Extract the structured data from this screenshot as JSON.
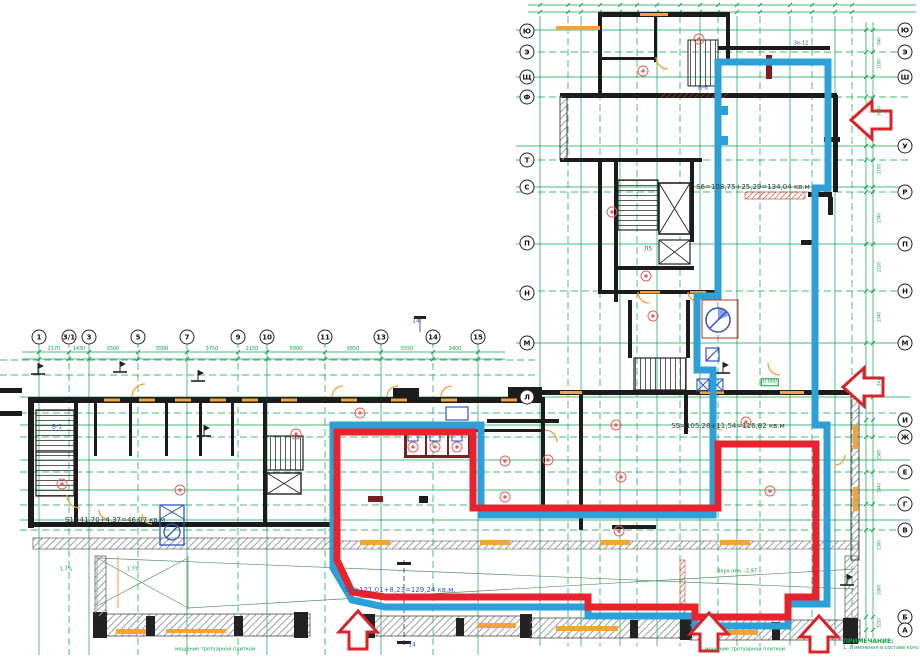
{
  "notes": {
    "heading": "ПРИМЕЧАНИЕ:",
    "line1": "1. Изменения в составе конструкций"
  },
  "axes": {
    "bottom_y": 337,
    "bottom_numbers": [
      {
        "label": "1",
        "x": 39
      },
      {
        "label": "3/1",
        "x": 69
      },
      {
        "label": "3",
        "x": 89
      },
      {
        "label": "5",
        "x": 138
      },
      {
        "label": "7",
        "x": 187
      },
      {
        "label": "9",
        "x": 238
      },
      {
        "label": "10",
        "x": 267
      },
      {
        "label": "11",
        "x": 325
      },
      {
        "label": "13",
        "x": 381
      },
      {
        "label": "14",
        "x": 433
      },
      {
        "label": "15",
        "x": 478
      }
    ],
    "tower_left_x": 527,
    "tower_left_letters": [
      {
        "label": "Ю",
        "y": 31
      },
      {
        "label": "Э",
        "y": 52
      },
      {
        "label": "Щ",
        "y": 77
      },
      {
        "label": "Ф",
        "y": 97
      },
      {
        "label": "Т",
        "y": 160
      },
      {
        "label": "С",
        "y": 187
      },
      {
        "label": "П",
        "y": 243
      },
      {
        "label": "Н",
        "y": 293
      },
      {
        "label": "М",
        "y": 343
      },
      {
        "label": "Л",
        "y": 397
      }
    ],
    "right_x": 905,
    "right_letters": [
      {
        "label": "Ю",
        "y": 30
      },
      {
        "label": "Э",
        "y": 52
      },
      {
        "label": "Ш",
        "y": 77
      },
      {
        "label": "У",
        "y": 146
      },
      {
        "label": "Р",
        "y": 192
      },
      {
        "label": "П",
        "y": 244
      },
      {
        "label": "Н",
        "y": 291
      },
      {
        "label": "М",
        "y": 343
      },
      {
        "label": "И",
        "y": 420
      },
      {
        "label": "Ж",
        "y": 437
      },
      {
        "label": "Е",
        "y": 472
      },
      {
        "label": "Г",
        "y": 504
      },
      {
        "label": "В",
        "y": 530
      },
      {
        "label": "Б",
        "y": 617
      },
      {
        "label": "А",
        "y": 630
      }
    ]
  },
  "annotations": [
    {
      "name": "area-label-s1",
      "text": "S1=41,70+4,37=46,07 кв.м",
      "x": 115,
      "y": 521,
      "cls": "dark",
      "size": 7
    },
    {
      "name": "area-label-s2",
      "text": "S2=121,01+8,23=129,24 кв.м.",
      "x": 400,
      "y": 591,
      "cls": "blue",
      "size": 7
    },
    {
      "name": "area-label-s5",
      "text": "S5=105,28+11,54=116,82 кв.м",
      "x": 728,
      "y": 427,
      "cls": "dark",
      "size": 7
    },
    {
      "name": "area-label-s6",
      "text": "S6=108,75+25,29=134,04 кв.м",
      "x": 753,
      "y": 188,
      "cls": "dark",
      "size": 7
    },
    {
      "name": "room-label",
      "text": "В-1",
      "x": 57,
      "y": 428,
      "cls": "blue",
      "size": 6
    },
    {
      "name": "room-label",
      "text": "В-6",
      "x": 703,
      "y": 89,
      "cls": "blue",
      "size": 6
    },
    {
      "name": "room-label",
      "text": "Л5",
      "x": 648,
      "y": 250,
      "cls": "blue",
      "size": 6
    },
    {
      "name": "room-label",
      "text": "Зн-12",
      "x": 801,
      "y": 44,
      "cls": "blue",
      "size": 5
    },
    {
      "name": "section-label",
      "text": "14",
      "x": 416,
      "y": 322,
      "cls": "blue",
      "size": 6
    },
    {
      "name": "section-label",
      "text": "14",
      "x": 412,
      "y": 646,
      "cls": "blue",
      "size": 6
    },
    {
      "name": "slope-label",
      "text": "1.7%",
      "x": 66,
      "y": 570,
      "cls": "green",
      "size": 5
    },
    {
      "name": "slope-label",
      "text": "1.7%",
      "x": 133,
      "y": 570,
      "cls": "green",
      "size": 5
    },
    {
      "name": "elevation-label",
      "text": "0.000",
      "x": 770,
      "y": 382,
      "cls": "greenbox",
      "size": 5
    },
    {
      "name": "terrace-note",
      "text": "Верх отм. -2.97",
      "x": 737,
      "y": 572,
      "cls": "green",
      "size": 5
    },
    {
      "name": "paving-note",
      "text": "мощение тротуарной плиткой",
      "x": 215,
      "y": 650,
      "cls": "green",
      "size": 5
    },
    {
      "name": "paving-note",
      "text": "мощение тротуарной плиткой",
      "x": 745,
      "y": 650,
      "cls": "green",
      "size": 5
    }
  ],
  "dimensions_top": [
    {
      "v": "2170",
      "x": 54
    },
    {
      "v": "1430",
      "x": 79
    },
    {
      "v": "3500",
      "x": 113
    },
    {
      "v": "3500",
      "x": 162
    },
    {
      "v": "3750",
      "x": 212
    },
    {
      "v": "2150",
      "x": 252
    },
    {
      "v": "5800",
      "x": 296
    },
    {
      "v": "3850",
      "x": 353
    },
    {
      "v": "3550",
      "x": 407
    },
    {
      "v": "3400",
      "x": 455
    }
  ],
  "dimensions_right": [
    {
      "v": "940",
      "y": 41
    },
    {
      "v": "1180",
      "y": 64
    },
    {
      "v": "3080",
      "y": 111
    },
    {
      "v": "2100",
      "y": 169
    },
    {
      "v": "2340",
      "y": 218
    },
    {
      "v": "2100",
      "y": 267
    },
    {
      "v": "2340",
      "y": 317
    },
    {
      "v": "3470",
      "y": 381
    },
    {
      "v": "1580",
      "y": 455
    },
    {
      "v": "1440",
      "y": 488
    },
    {
      "v": "2280",
      "y": 545
    },
    {
      "v": "1060",
      "y": 590
    },
    {
      "v": "3220",
      "y": 623
    }
  ],
  "markers": [
    [
      62,
      484
    ],
    [
      180,
      490
    ],
    [
      296,
      434
    ],
    [
      360,
      413
    ],
    [
      413,
      447
    ],
    [
      435,
      447
    ],
    [
      457,
      447
    ],
    [
      505,
      461
    ],
    [
      548,
      460
    ],
    [
      505,
      497
    ],
    [
      616,
      425
    ],
    [
      621,
      477
    ],
    [
      619,
      531
    ],
    [
      643,
      71
    ],
    [
      699,
      39
    ],
    [
      612,
      212
    ],
    [
      646,
      276
    ],
    [
      653,
      316
    ],
    [
      746,
      422
    ],
    [
      770,
      491
    ]
  ],
  "colors": {
    "grid_green": "#0ba24f",
    "outline_red": "#e8232e",
    "outline_blue": "#2da0d8",
    "wall_black": "#1c1c1c",
    "door_orange": "#f0a030",
    "marker_red": "#e06060",
    "annotation_blue": "#3757b8",
    "annotation_green": "#12a14b"
  }
}
